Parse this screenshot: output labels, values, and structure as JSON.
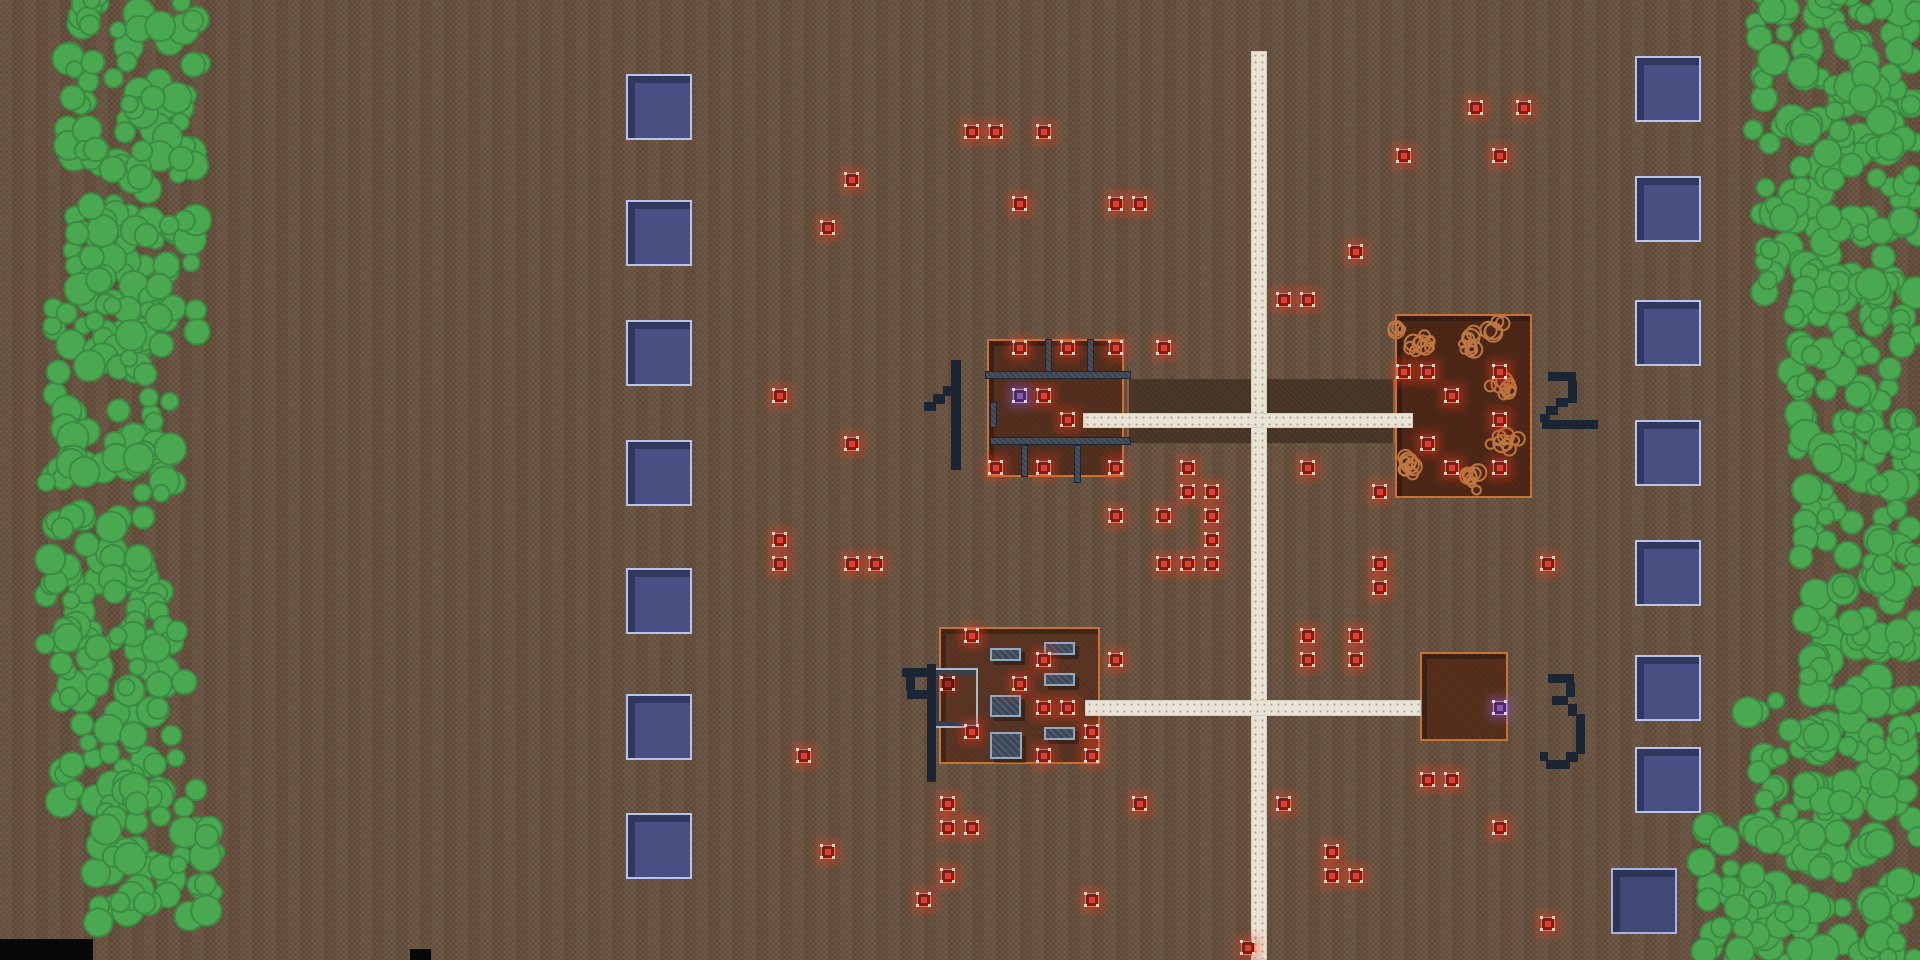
{
  "scene": {
    "width": 1920,
    "height": 960,
    "description": "top-down pixel game map: dirt field, tree lines, roads, four numbered compounds, supply pads, loot markers"
  },
  "colors": {
    "ground": "#6b5542",
    "road": "#e9e3d6",
    "tree_fill": "#4aa851",
    "tree_stroke": "#3c8b42",
    "building_border": "#c8732f",
    "wall": "#3a434f",
    "furniture": "#3c4654",
    "rubble_stroke": "#bd7740",
    "pad_fill": "#475081",
    "pad_border": "#bac3ec",
    "marker_red": "#e04030",
    "marker_purple": "#8d5bb0",
    "label_ink": "#1c2533",
    "yard": "#4a3829"
  },
  "roads": {
    "vertical": [
      1251,
      51,
      16,
      909
    ],
    "horizontal_upper": [
      1083,
      413,
      330,
      15
    ],
    "horizontal_lower": [
      1085,
      700,
      336,
      16
    ]
  },
  "yard": [
    1127,
    379,
    268,
    64
  ],
  "buildings": [
    {
      "id": 1,
      "label": "1",
      "rect": [
        987,
        339,
        137,
        138
      ],
      "floor": "#54301f"
    },
    {
      "id": 2,
      "label": "2",
      "rect": [
        1395,
        314,
        137,
        184
      ],
      "floor": "#4e2817"
    },
    {
      "id": 3,
      "label": "4",
      "rect": [
        939,
        627,
        161,
        137
      ],
      "floor": "#5a3524"
    },
    {
      "id": 4,
      "label": "3",
      "rect": [
        1420,
        652,
        88,
        89
      ],
      "floor": "#57301c"
    }
  ],
  "labels": [
    {
      "label": "1",
      "x": 918,
      "y": 356
    },
    {
      "label": "2",
      "x": 1536,
      "y": 368
    },
    {
      "label": "3",
      "x": 1540,
      "y": 668
    },
    {
      "label": "4",
      "x": 898,
      "y": 662
    }
  ],
  "walls": [
    [
      985,
      371,
      146,
      8
    ],
    [
      990,
      437,
      141,
      8
    ],
    [
      1045,
      339,
      7,
      33
    ],
    [
      1087,
      339,
      7,
      33
    ],
    [
      1021,
      445,
      7,
      32
    ],
    [
      1074,
      445,
      7,
      38
    ],
    [
      990,
      402,
      7,
      26
    ]
  ],
  "furniture": [
    [
      990,
      648,
      31,
      13
    ],
    [
      1044,
      642,
      31,
      13
    ],
    [
      1044,
      673,
      31,
      13
    ],
    [
      990,
      695,
      31,
      22
    ],
    [
      1044,
      727,
      31,
      13
    ],
    [
      990,
      732,
      32,
      27
    ]
  ],
  "c_structure": {
    "rect": [
      934,
      670,
      42,
      56
    ]
  },
  "rubble_clusters": [
    [
      1422,
      342,
      15,
      10
    ],
    [
      1472,
      340,
      15,
      10
    ],
    [
      1502,
      390,
      13,
      9
    ],
    [
      1505,
      440,
      15,
      10
    ],
    [
      1412,
      462,
      15,
      10
    ],
    [
      1468,
      478,
      15,
      9
    ],
    [
      1497,
      328,
      9,
      5
    ],
    [
      1400,
      330,
      8,
      4
    ]
  ],
  "pads": {
    "size": 66,
    "left_column": {
      "x": 626,
      "tops": [
        74,
        200,
        320,
        440,
        568,
        694,
        813
      ]
    },
    "right_column": {
      "x": 1635,
      "tops": [
        56,
        176,
        300,
        420,
        540,
        655,
        747
      ]
    },
    "offset_pad": {
      "x": 1611,
      "y": 868,
      "dim": true
    }
  },
  "markers": {
    "red": [
      [
        972,
        132
      ],
      [
        996,
        132
      ],
      [
        1044,
        132
      ],
      [
        852,
        180
      ],
      [
        1020,
        204
      ],
      [
        1116,
        204
      ],
      [
        1140,
        204
      ],
      [
        828,
        228
      ],
      [
        1476,
        108
      ],
      [
        1524,
        108
      ],
      [
        1404,
        156
      ],
      [
        1500,
        156
      ],
      [
        1356,
        252
      ],
      [
        1284,
        300
      ],
      [
        1308,
        300
      ],
      [
        1164,
        348
      ],
      [
        1020,
        348
      ],
      [
        1068,
        348
      ],
      [
        1116,
        348
      ],
      [
        1044,
        396
      ],
      [
        1068,
        420
      ],
      [
        996,
        468
      ],
      [
        1044,
        468
      ],
      [
        1116,
        468
      ],
      [
        1404,
        372
      ],
      [
        1428,
        372
      ],
      [
        1500,
        372
      ],
      [
        1452,
        396
      ],
      [
        1500,
        420
      ],
      [
        1428,
        444
      ],
      [
        1452,
        468
      ],
      [
        1500,
        468
      ],
      [
        780,
        396
      ],
      [
        852,
        444
      ],
      [
        780,
        540
      ],
      [
        780,
        564
      ],
      [
        852,
        564
      ],
      [
        876,
        564
      ],
      [
        1116,
        516
      ],
      [
        1164,
        516
      ],
      [
        1164,
        564
      ],
      [
        1116,
        660
      ],
      [
        1188,
        468
      ],
      [
        1188,
        492
      ],
      [
        1212,
        492
      ],
      [
        1212,
        516
      ],
      [
        1212,
        540
      ],
      [
        1188,
        564
      ],
      [
        1212,
        564
      ],
      [
        1308,
        468
      ],
      [
        1380,
        492
      ],
      [
        1380,
        564
      ],
      [
        1380,
        588
      ],
      [
        1548,
        564
      ],
      [
        1308,
        636
      ],
      [
        1356,
        636
      ],
      [
        1308,
        660
      ],
      [
        1356,
        660
      ],
      [
        972,
        636
      ],
      [
        1044,
        660
      ],
      [
        1020,
        684
      ],
      [
        1044,
        708
      ],
      [
        1068,
        708
      ],
      [
        972,
        732
      ],
      [
        1092,
        732
      ],
      [
        1044,
        756
      ],
      [
        1092,
        756
      ],
      [
        804,
        756
      ],
      [
        948,
        804
      ],
      [
        948,
        828
      ],
      [
        972,
        828
      ],
      [
        828,
        852
      ],
      [
        948,
        876
      ],
      [
        924,
        900
      ],
      [
        1092,
        900
      ],
      [
        1140,
        804
      ],
      [
        1428,
        780
      ],
      [
        1452,
        780
      ],
      [
        1500,
        828
      ],
      [
        1332,
        852
      ],
      [
        1332,
        876
      ],
      [
        1356,
        876
      ],
      [
        1548,
        924
      ],
      [
        1284,
        804
      ],
      [
        1248,
        948
      ]
    ],
    "purple": [
      [
        1020,
        396
      ],
      [
        1500,
        708
      ]
    ],
    "darkred": [
      [
        948,
        684
      ]
    ]
  },
  "trees": {
    "left_segments": [
      [
        60,
        -15,
        145,
        190
      ],
      [
        66,
        140,
        140,
        200
      ],
      [
        46,
        300,
        135,
        190
      ],
      [
        40,
        450,
        135,
        200
      ],
      [
        52,
        610,
        140,
        200
      ],
      [
        88,
        770,
        135,
        160
      ]
    ],
    "right_segments": [
      [
        1745,
        -15,
        180,
        170
      ],
      [
        1755,
        120,
        170,
        180
      ],
      [
        1785,
        270,
        140,
        160
      ],
      [
        1790,
        410,
        140,
        160
      ],
      [
        1795,
        550,
        130,
        160
      ],
      [
        1740,
        690,
        185,
        150
      ],
      [
        1688,
        820,
        235,
        150
      ]
    ],
    "density": 420
  },
  "bottom_bars": [
    [
      0,
      939,
      93,
      21
    ],
    [
      410,
      949,
      21,
      11
    ]
  ]
}
